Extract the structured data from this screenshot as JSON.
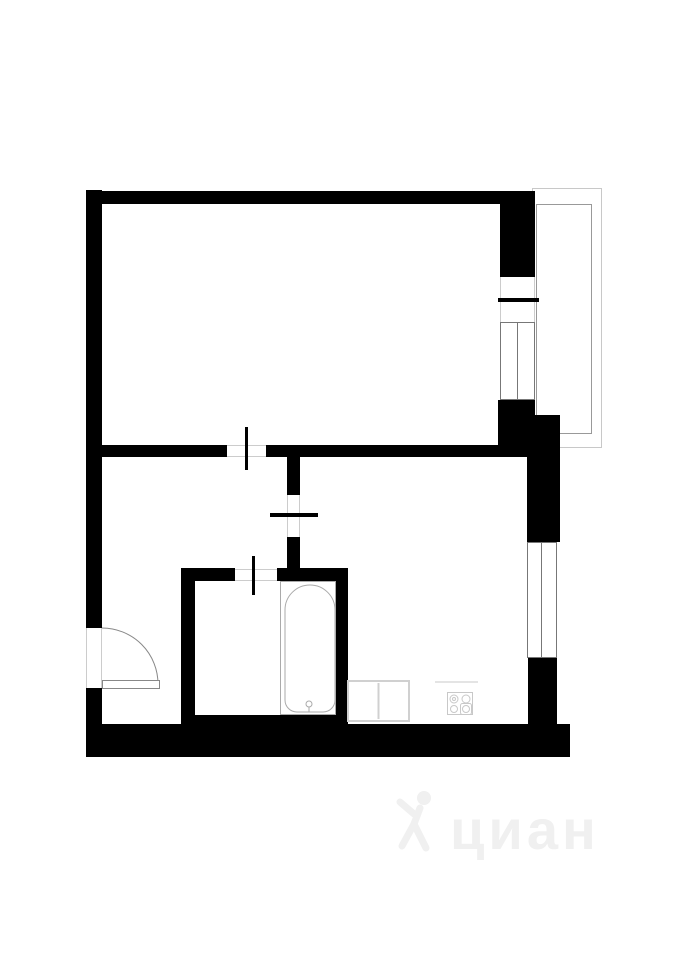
{
  "canvas": {
    "w": 679,
    "h": 960,
    "bg": "#ffffff"
  },
  "colors": {
    "wall": "#000000",
    "window_frame": "#777777",
    "opening_edge": "#cccccc",
    "door": "#888888",
    "bath_fixture": "#aaaaaa",
    "kitchen_fixture": "#c8c8c8",
    "sink_outline": "#d0d0d0",
    "balcony_outer": "#c8c8c8",
    "balcony_inner": "#999999"
  },
  "balcony": {
    "outer": {
      "x": 532,
      "y": 188,
      "w": 69,
      "h": 259
    },
    "inner": {
      "x": 536,
      "y": 204,
      "w": 55,
      "h": 229
    }
  },
  "walls": [
    {
      "name": "top-wall",
      "x": 88,
      "y": 191,
      "w": 447,
      "h": 13
    },
    {
      "name": "left-wall-upper",
      "x": 86,
      "y": 190,
      "w": 16,
      "h": 438
    },
    {
      "name": "left-wall-lower",
      "x": 86,
      "y": 688,
      "w": 16,
      "h": 69
    },
    {
      "name": "bottom-wall",
      "x": 86,
      "y": 724,
      "w": 484,
      "h": 33
    },
    {
      "name": "bathroom-bottom-strip",
      "x": 181,
      "y": 715,
      "w": 167,
      "h": 10
    },
    {
      "name": "divider-wall-left",
      "x": 100,
      "y": 445,
      "w": 127,
      "h": 12
    },
    {
      "name": "divider-wall-right",
      "x": 266,
      "y": 445,
      "w": 261,
      "h": 12
    },
    {
      "name": "hall-kitchen-wall-upper",
      "x": 287,
      "y": 445,
      "w": 13,
      "h": 50
    },
    {
      "name": "hall-kitchen-wall-lower",
      "x": 287,
      "y": 537,
      "w": 13,
      "h": 44
    },
    {
      "name": "bathroom-top-wall-left",
      "x": 181,
      "y": 568,
      "w": 54,
      "h": 13
    },
    {
      "name": "bathroom-top-wall-right",
      "x": 277,
      "y": 568,
      "w": 71,
      "h": 13
    },
    {
      "name": "bathroom-left-wall",
      "x": 181,
      "y": 568,
      "w": 14,
      "h": 156
    },
    {
      "name": "bathroom-right-wall",
      "x": 336,
      "y": 568,
      "w": 12,
      "h": 156
    },
    {
      "name": "living-right-wall-top",
      "x": 500,
      "y": 191,
      "w": 35,
      "h": 86
    },
    {
      "name": "living-right-wall-bottom",
      "x": 498,
      "y": 400,
      "w": 37,
      "h": 57
    },
    {
      "name": "kitchen-right-wall-top",
      "x": 527,
      "y": 415,
      "w": 33,
      "h": 127
    },
    {
      "name": "kitchen-right-wall-bottom",
      "x": 528,
      "y": 658,
      "w": 29,
      "h": 66
    }
  ],
  "openings": [
    {
      "name": "living-door-opening",
      "x": 227,
      "y": 445,
      "w": 39,
      "h": 12,
      "edges": "h"
    },
    {
      "name": "kitchen-door-opening",
      "x": 287,
      "y": 495,
      "w": 13,
      "h": 42,
      "edges": "v"
    },
    {
      "name": "bathroom-door-opening",
      "x": 235,
      "y": 569,
      "w": 42,
      "h": 12,
      "edges": "h"
    },
    {
      "name": "entrance-opening",
      "x": 86,
      "y": 628,
      "w": 16,
      "h": 60,
      "edges": "v"
    },
    {
      "name": "balcony-door-opening",
      "x": 500,
      "y": 277,
      "w": 35,
      "h": 45,
      "edges": "v"
    }
  ],
  "door_ticks": [
    {
      "name": "living-door-tick",
      "x": 245,
      "y": 427,
      "w": 3,
      "h": 43
    },
    {
      "name": "kitchen-door-tick",
      "x": 270,
      "y": 513,
      "w": 48,
      "h": 4
    },
    {
      "name": "bathroom-door-tick",
      "x": 252,
      "y": 556,
      "w": 3,
      "h": 39
    },
    {
      "name": "balcony-door-tick",
      "x": 498,
      "y": 298,
      "w": 41,
      "h": 4
    }
  ],
  "windows": [
    {
      "name": "living-room-window",
      "x": 500,
      "y": 322,
      "w": 35,
      "h": 78,
      "mid": 17.5
    },
    {
      "name": "kitchen-window",
      "x": 527,
      "y": 542,
      "w": 30,
      "h": 116,
      "mid": 14.5
    }
  ],
  "entrance_door": {
    "leaf": {
      "x": 102,
      "y": 680,
      "w": 57,
      "h": 8
    },
    "arc_path": "M 158 684 A 56 56 0 0 0 102 628"
  },
  "bathtub": {
    "surround": {
      "x": 280,
      "y": 581,
      "w": 56,
      "h": 134
    },
    "tub_path": "M 285 610 A 25 25 0 0 1 335 610 L 335 700 A 12 12 0 0 1 323 712 L 297 712 A 12 12 0 0 1 285 700 Z",
    "drain": {
      "cx": 309,
      "cy": 704,
      "r": 3,
      "stem_y2": 712
    }
  },
  "kitchen": {
    "sink": {
      "x": 347,
      "y": 680,
      "w": 63,
      "h": 42,
      "divider_x": 378.5
    },
    "stove": {
      "x": 447,
      "y": 692,
      "w": 26,
      "h": 23,
      "burners": [
        {
          "cx": 454,
          "cy": 699,
          "r": 4,
          "inner": true
        },
        {
          "cx": 466,
          "cy": 699,
          "r": 4
        },
        {
          "cx": 454,
          "cy": 709,
          "r": 3.5
        },
        {
          "cx": 466,
          "cy": 709,
          "r": 3.5,
          "boxed": true
        }
      ]
    },
    "counter_line": {
      "x1": 435,
      "y1": 682,
      "x2": 478,
      "y2": 682
    }
  },
  "watermark": {
    "text": "циан",
    "color": "#f0f0f0",
    "x": 394,
    "y": 788,
    "font_size": 56,
    "letter_spacing": 4
  }
}
